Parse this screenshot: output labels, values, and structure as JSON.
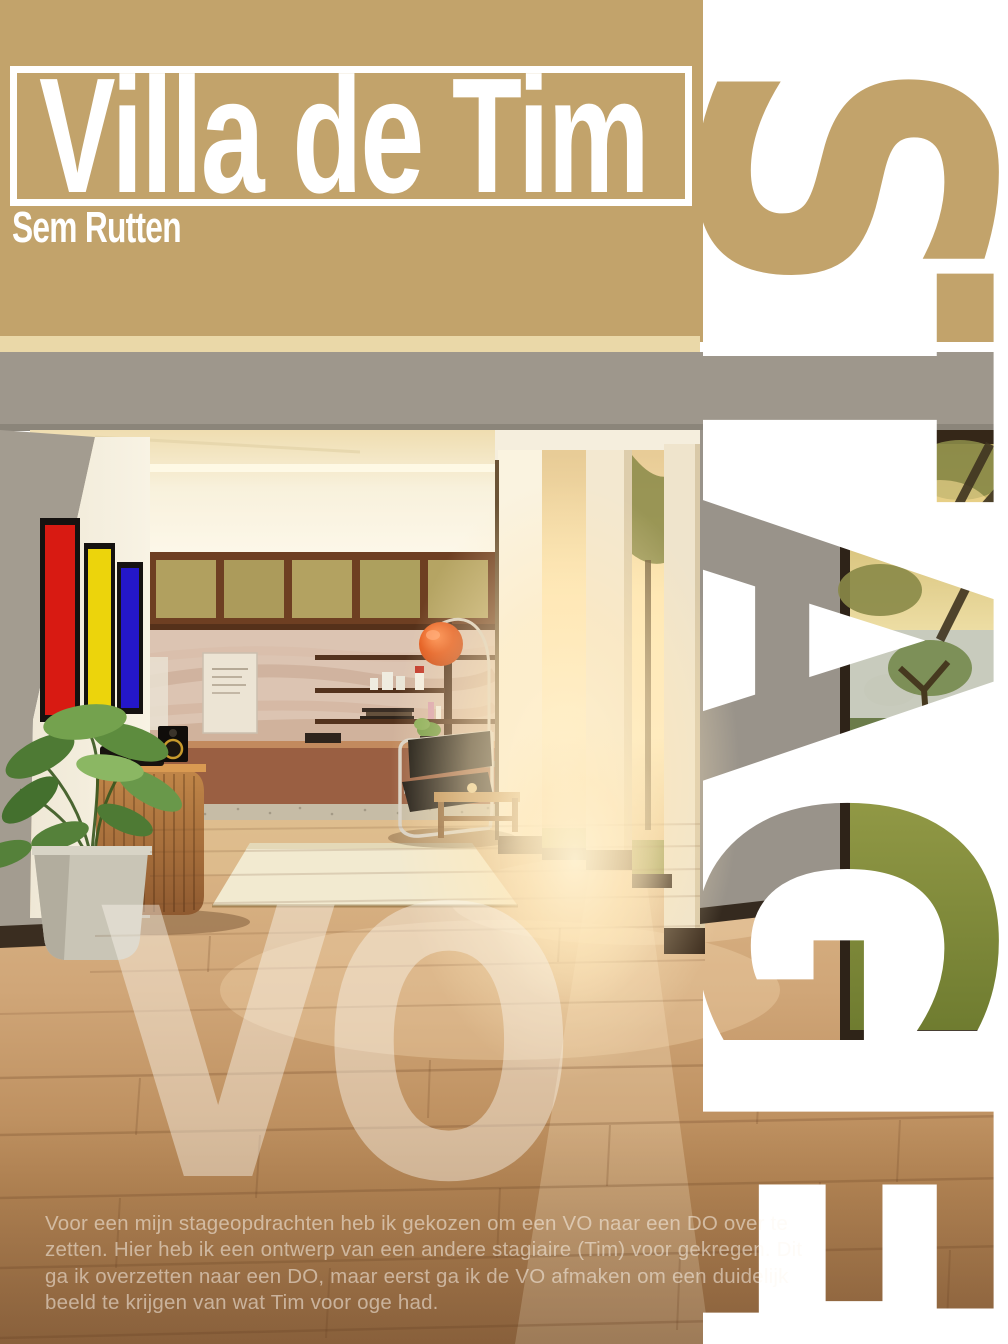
{
  "header": {
    "title": "Villa de Tim",
    "author": "Sem Rutten"
  },
  "side_word": {
    "word": "STAGE",
    "letters": [
      "S",
      "T",
      "A",
      "G",
      "E"
    ]
  },
  "watermark": {
    "text": "VO"
  },
  "body_text": {
    "lines": [
      "Voor een mijn stageopdrachten heb ik gekozen om een VO naar een DO over te",
      "zetten.  Hier heb ik een ontwerp van een andere stagiaire (Tim) voor gekregen. Dit",
      "ga ik overzetten naar een DO, maar eerst ga ik de VO afmaken om een duidelijk",
      "beeld te krijgen van wat Tim voor oge had."
    ]
  },
  "colors": {
    "header_tan": "#c2a36b",
    "strip_white": "#ffffff",
    "panel_red": "#d81a12",
    "panel_yellow": "#ecd40c",
    "panel_blue": "#2417c9",
    "lamp_orange": "#e2581e",
    "wall_gray": "#9e978c",
    "floor_wood": "#c9a172"
  }
}
